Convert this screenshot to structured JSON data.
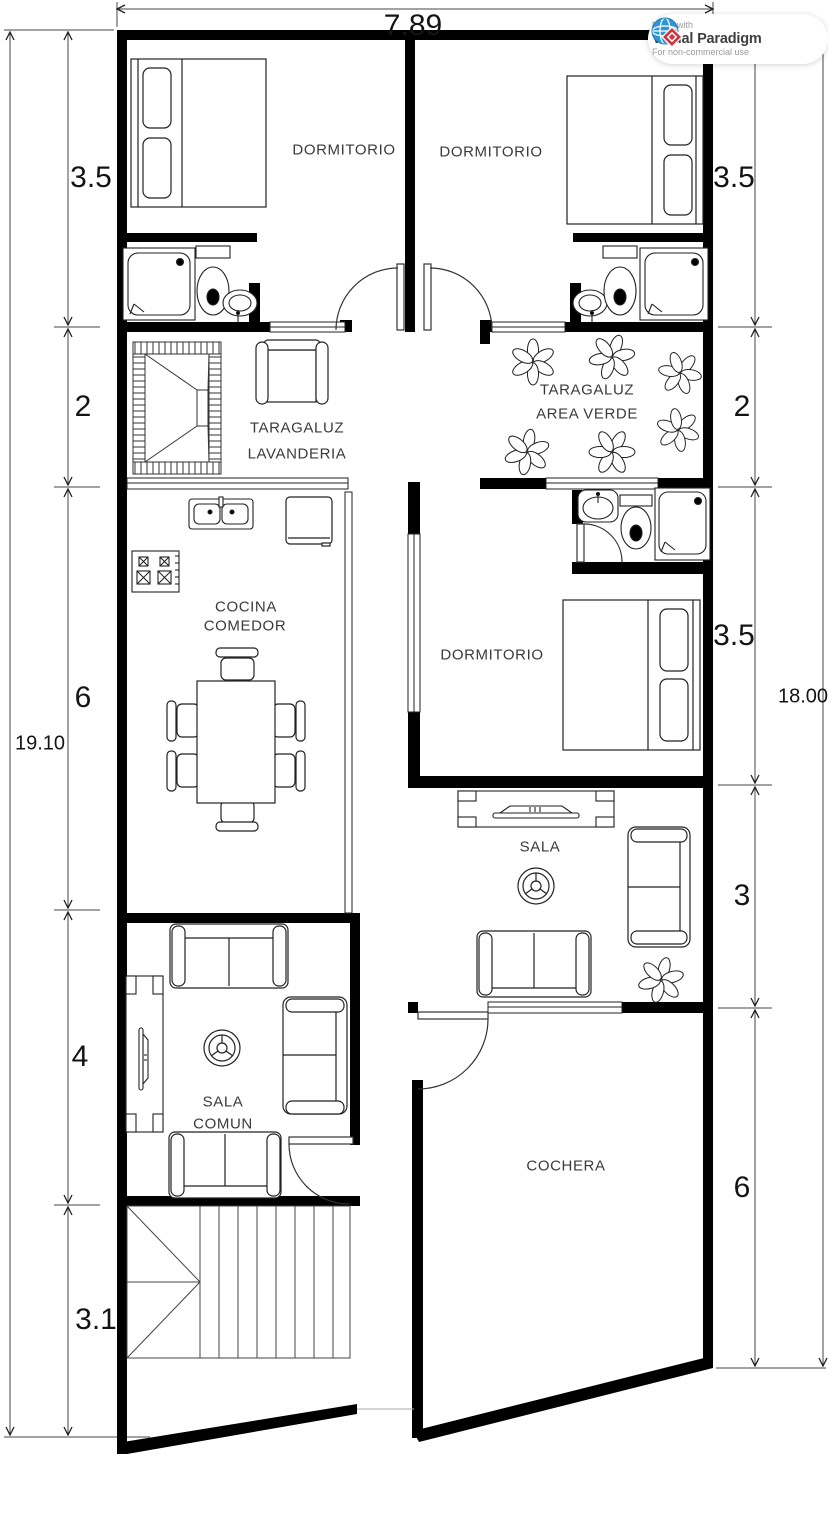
{
  "badge": {
    "made_with": "Made with",
    "brand": "Visual Paradigm",
    "license": "For non-commercial use"
  },
  "dimensions": {
    "top_width": "7.89",
    "left_total": "19.10",
    "right_total": "18.00",
    "left_chain": [
      "3.5",
      "2",
      "6",
      "4",
      "3.1"
    ],
    "right_chain": [
      "3.5",
      "2",
      "3.5",
      "3",
      "6"
    ]
  },
  "rooms": {
    "bedroom_top_left": "DORMITORIO",
    "bedroom_top_right": "DORMITORIO",
    "laundry_line1": "TARAGALUZ",
    "laundry_line2": "LAVANDERIA",
    "green_area_line1": "TARAGALUZ",
    "green_area_line2": "AREA VERDE",
    "kitchen_line1": "COCINA",
    "kitchen_line2": "COMEDOR",
    "bedroom_middle": "DORMITORIO",
    "living_room": "SALA",
    "common_room_line1": "SALA",
    "common_room_line2": "COMUN",
    "garage": "COCHERA"
  }
}
